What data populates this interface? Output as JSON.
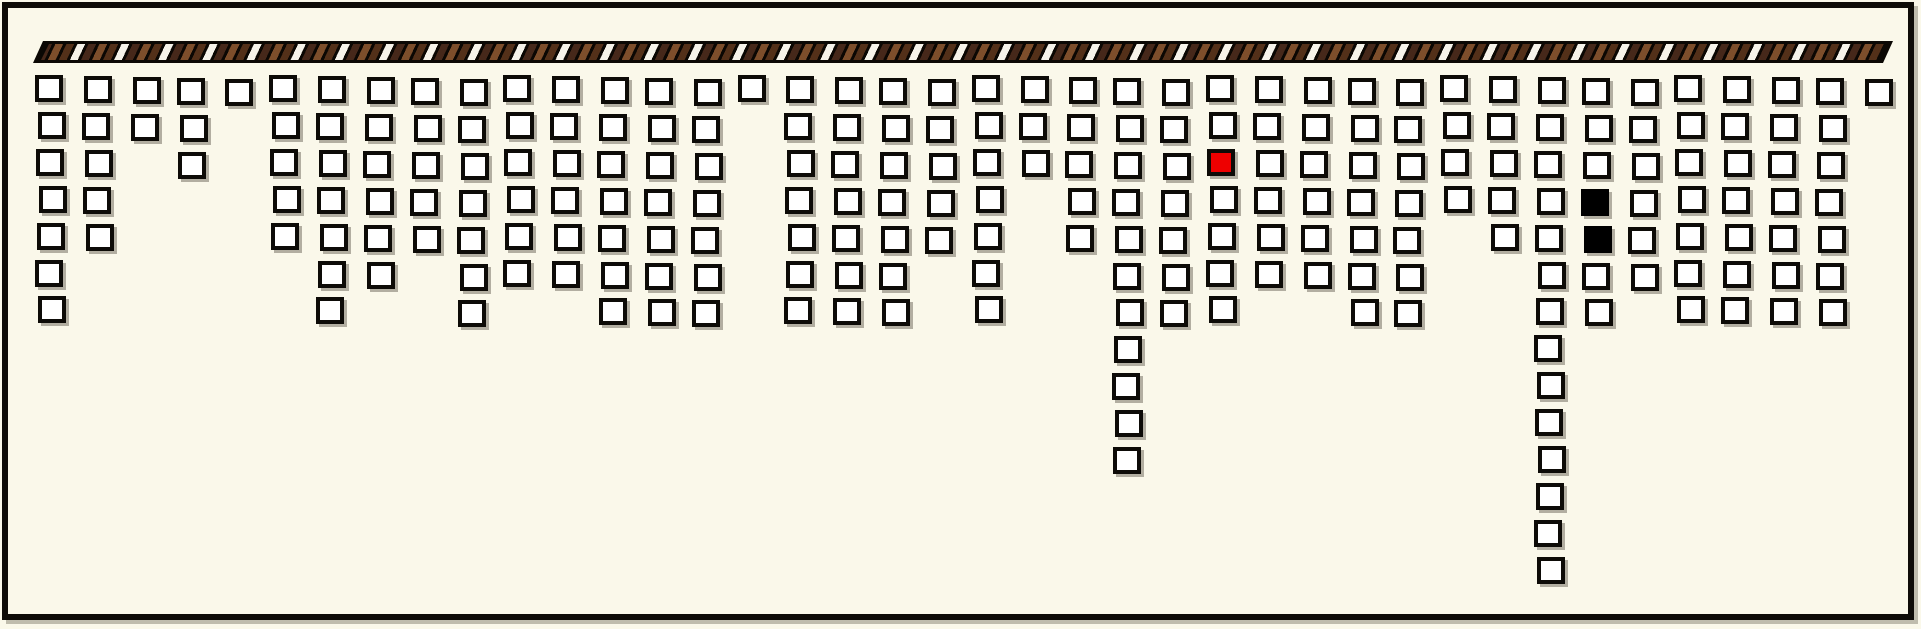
{
  "board": {
    "description": "tile board hanging from striped rail",
    "background_color": "#faf8ea",
    "frame_color": "#0e0c08",
    "columns": 40,
    "max_rows": 14,
    "total_cells": 239,
    "column_counts": [
      7,
      5,
      2,
      3,
      1,
      5,
      7,
      6,
      5,
      7,
      6,
      6,
      7,
      7,
      7,
      1,
      7,
      7,
      7,
      5,
      7,
      3,
      5,
      11,
      7,
      7,
      6,
      6,
      7,
      7,
      4,
      5,
      14,
      7,
      6,
      7,
      7,
      7,
      7,
      1
    ],
    "cell_colors": {
      "default": "#ffffff",
      "border": "#0d0b07",
      "red": "#ee0000",
      "black": "#000000"
    },
    "special_cells": [
      {
        "col": 25,
        "row": 2,
        "color": "red"
      },
      {
        "col": 33,
        "row": 3,
        "color": "black"
      },
      {
        "col": 33,
        "row": 4,
        "color": "black"
      }
    ]
  },
  "rail": {
    "stripe_colors": {
      "base_black": "#0b0804",
      "dark_brown": "#46281a",
      "mid_brown": "#7d4e2b",
      "white": "#f6f3ea"
    }
  }
}
